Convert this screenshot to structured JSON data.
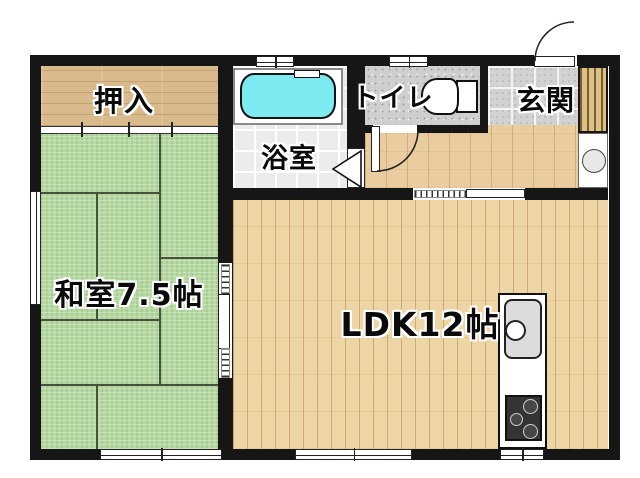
{
  "floor_plan": {
    "rooms": {
      "oshiire": {
        "label": "押入"
      },
      "bathroom": {
        "label": "浴室"
      },
      "toilet": {
        "label": "トイレ"
      },
      "genkan": {
        "label": "玄関"
      },
      "washitsu": {
        "label": "和室7.5帖",
        "tatami_count": "7.5"
      },
      "ldk": {
        "label": "LDK12帖",
        "tatami_count": "12"
      }
    },
    "fixtures": [
      "bathtub-icon",
      "toilet-bowl-icon",
      "kitchen-sink-icon",
      "gas-stove-icon",
      "washing-machine-space-icon",
      "shoe-cabinet-icon",
      "entrance-door-swing-icon",
      "toilet-door-swing-icon",
      "bathroom-folding-door-icon",
      "sliding-door-icon"
    ],
    "colors": {
      "wall": "#161616",
      "tatami_green": "#b6d8a1",
      "flooring_wood": "#eed5a6",
      "closet_wood": "#d9ba8d",
      "bathtub_cyan": "#7de9f0",
      "entrance_tile": "#d2d2d2",
      "background": "#ffffff"
    }
  }
}
